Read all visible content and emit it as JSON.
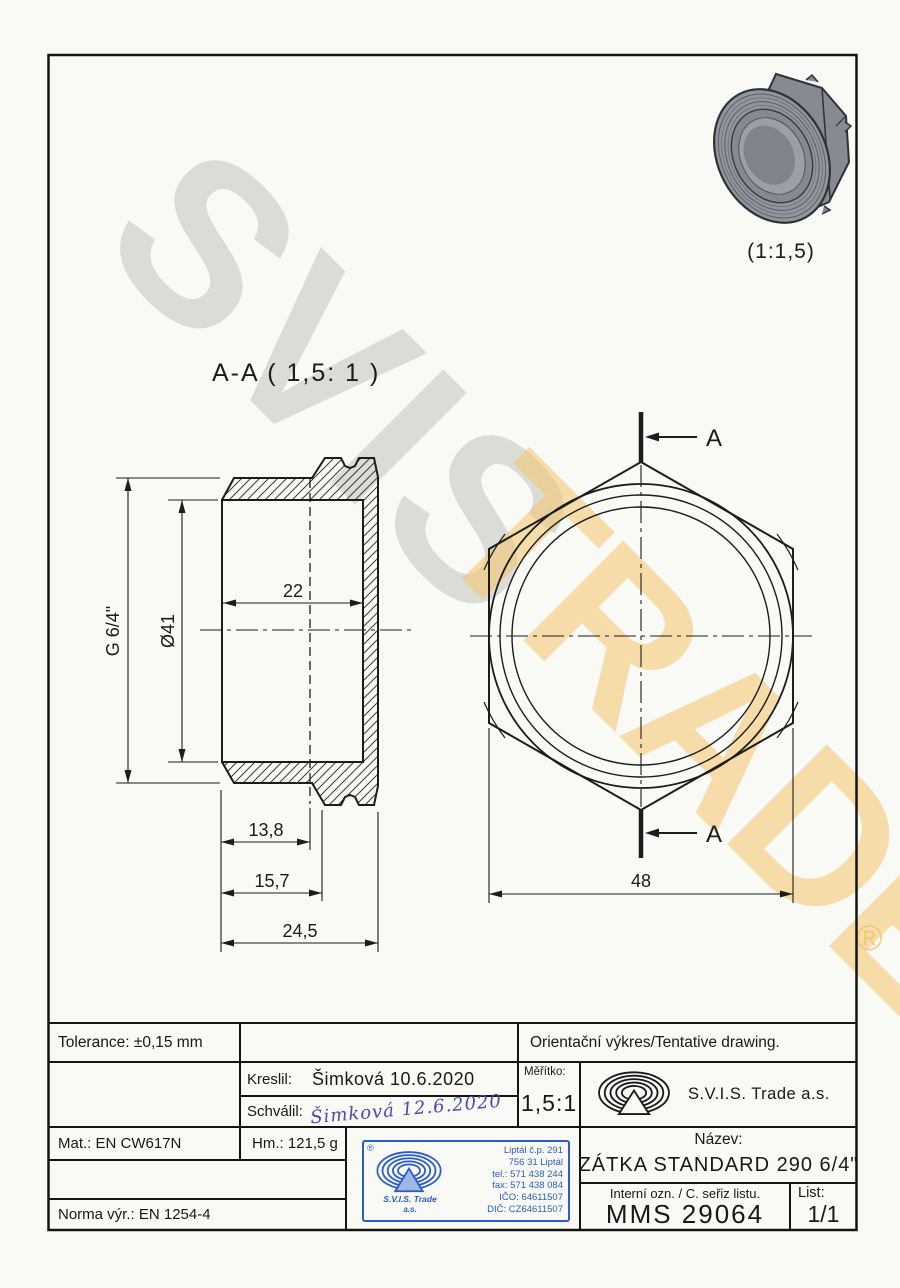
{
  "watermark": {
    "line1": "SVIS",
    "line2": "TRADE",
    "registered": "®",
    "gray_color": "#d6d6d6",
    "yellow_color": "#f2c46a"
  },
  "labels": {
    "section": "A-A ( 1,5: 1 )",
    "preview_scale": "(1:1,5)",
    "cut_top": "A",
    "cut_bottom": "A"
  },
  "dims": {
    "thread": "G 6/4\"",
    "bore": "Ø41",
    "depth22": "22",
    "d138": "13,8",
    "d157": "15,7",
    "d245": "24,5",
    "hex48": "48"
  },
  "titleblock": {
    "tolerance": "Tolerance: ±0,15 mm",
    "orientation_note": "Orientační výkres/Tentative drawing.",
    "kreslil_label": "Kreslil:",
    "kreslil_value": "Šimková 10.6.2020",
    "schvalil_label": "Schválil:",
    "schvalil_value": "Šimková 12.6.2020",
    "meritko_label": "Měřítko:",
    "meritko_value": "1,5:1",
    "company": "S.V.I.S. Trade a.s.",
    "mat": "Mat.: EN CW617N",
    "hm": "Hm.: 121,5 g",
    "norma": "Norma výr.: EN 1254-4",
    "nazev_label": "Název:",
    "nazev_value": "ZÁTKA STANDARD 290 6/4\"",
    "interni_label": "Interní ozn. / C. seřiz listu.",
    "interni_value": "MMS 29064",
    "list_label": "List:",
    "list_value": "1/1"
  },
  "stamp": {
    "registered": "®",
    "lines": [
      "Liptál č.p. 291",
      "756 31 Liptál",
      "tel.: 571 438 244",
      "fax: 571 438 084",
      "IČO: 64611507",
      "DIČ: CZ64611507"
    ],
    "company_line1": "S.V.I.S. Trade",
    "company_line2": "a.s.",
    "color": "#2a5cc8"
  }
}
